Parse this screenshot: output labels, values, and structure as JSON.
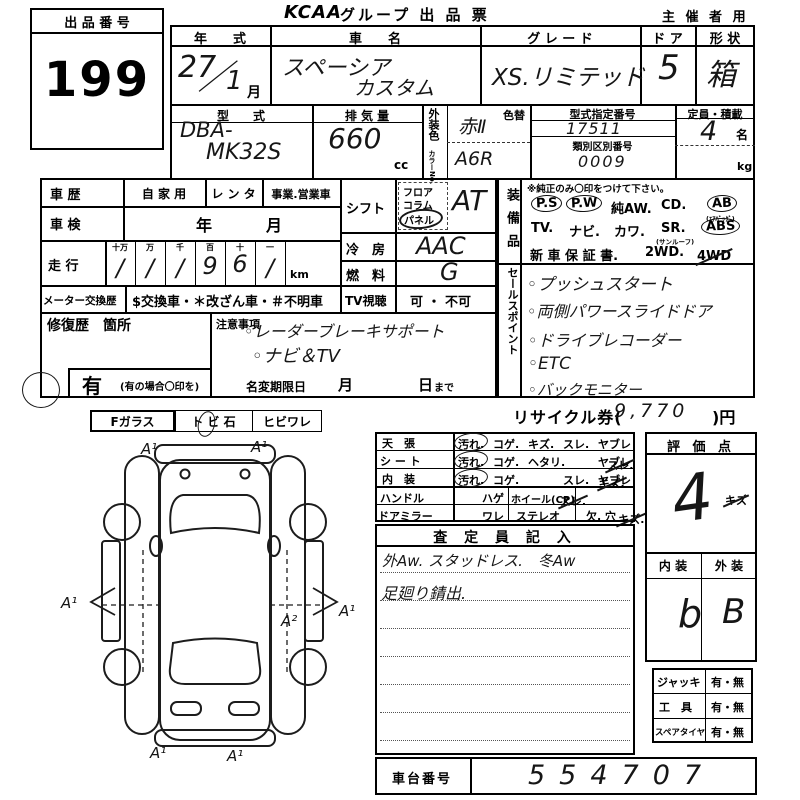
{
  "sheet": {
    "lot_label": "出 品 番 号",
    "lot_number": "199",
    "brand": "KCAA",
    "title": "グループ 出 品 票",
    "audience": "主 催 者 用"
  },
  "vehicle": {
    "year_label": "年　　式",
    "year_value": "27",
    "year_slash": "／",
    "year_month": "1",
    "month_unit": "月",
    "name_label": "車　　名",
    "name_value_1": "スペーシア",
    "name_value_2": "カスタム",
    "grade_label": "グ レ ー ド",
    "grade_value": "XS.リミテッド",
    "door_label": "ド ア",
    "door_value": "5",
    "shape_label": "形 状",
    "shape_value": "箱",
    "model_label": "型　　式",
    "model_value_1": "DBA-",
    "model_value_2": "MK32S",
    "disp_label": "排 気 量",
    "disp_value": "660",
    "disp_unit": "cc",
    "ext_color_label": "外装色",
    "color_no_label": "カラーNo.",
    "color_value": "赤Ⅱ",
    "color_no_value": "A6R",
    "color_change_label": "色替",
    "type_no_label": "型式指定番号",
    "type_no_value": "17511",
    "class_no_label": "類別区別番号",
    "class_no_value": "0009",
    "capacity_label": "定員・積載",
    "capacity_value": "4",
    "capacity_unit": "名",
    "weight_unit": "kg"
  },
  "history": {
    "label": "車 歴",
    "private": "自 家 用",
    "rental": "レ ン タ",
    "commercial": "事業.営業車",
    "inspection_label": "車 検",
    "inspection_year": "年",
    "inspection_month": "月",
    "mileage_label": "走 行",
    "mileage_cols": [
      "十万",
      "万",
      "千",
      "百",
      "十",
      "一"
    ],
    "mileage_digits": [
      "/",
      "/",
      "/",
      "9",
      "6",
      "/"
    ],
    "mileage_unit": "km",
    "meter_label": "メーター交換歴",
    "meter_codes": "$交換車・＊改ざん車・＃不明車",
    "tv_label": "TV視聴",
    "tv_options": "可 ・ 不可"
  },
  "controls": {
    "shift_label": "シフト",
    "shift_floor": "フロア",
    "shift_column": "コラム",
    "shift_panel": "パネル",
    "shift_value": "AT",
    "ac_label": "冷　房",
    "ac_value": "AAC",
    "fuel_label": "燃　料",
    "fuel_value": "G"
  },
  "repair": {
    "label": "修復歴　箇所",
    "has_label": "有",
    "has_note": "(有の場合〇印を)"
  },
  "notes": {
    "label": "注意事項",
    "bullet": "◦",
    "items": [
      "レーダーブレーキサポート",
      "ナビ＆TV"
    ],
    "deadline_label": "名変期限日",
    "deadline_month": "月",
    "deadline_day": "日",
    "deadline_until": "まで"
  },
  "equipment": {
    "label": "装備品",
    "note": "※純正のみ〇印をつけて下さい。",
    "row1": [
      "P.S",
      "P.W",
      "純AW.",
      "CD.",
      "AB"
    ],
    "row1_sub": "(ｴｱﾊﾞｯｸﾞ)",
    "row2": [
      "TV.",
      "ナビ.",
      "カワ.",
      "SR.",
      "ABS"
    ],
    "row2_sub": "(サンルーフ)",
    "row3": [
      "新 車 保 証 書.",
      "2WD.",
      "4WD"
    ],
    "circled": [
      "P.S",
      "P.W",
      "AB",
      "ABS"
    ]
  },
  "sales": {
    "label": "セールスポイント",
    "bullet": "◦",
    "items": [
      "プッシュスタート",
      "両側パワースライドドア",
      "ドライブレコーダー",
      "ETC",
      "バックモニター"
    ]
  },
  "recycle": {
    "label_prefix": "リサイクル券(",
    "value": "9,770",
    "label_suffix": ")円"
  },
  "condition": {
    "rows": [
      {
        "label": "天　張",
        "options": [
          "汚れ.",
          "コゲ.",
          "キズ.",
          "スレ.",
          "ヤブレ"
        ],
        "circled": "汚れ"
      },
      {
        "label": "シ ー ト",
        "options": [
          "汚れ.",
          "コゲ.",
          "ヘタリ.",
          "スレ.",
          "ヤブレ"
        ],
        "circled": "汚れ",
        "checked": "スレ"
      },
      {
        "label": "内　装",
        "options": [
          "汚れ.",
          "コゲ.",
          "キズ.",
          "スレ.",
          "ヤブレ"
        ],
        "circled": "汚れ",
        "checked": "キズ"
      }
    ],
    "handle_label": "ハンドル",
    "handle_opt1": "スレ.",
    "handle_opt2": "ハゲ",
    "wheel_label": "ホイール(CP)",
    "wheel_value": "キズ",
    "mirror_label": "ドアミラー",
    "mirror_opt1": "キズ.",
    "mirror_opt2": "ワレ",
    "stereo_label": "ステレオ",
    "stereo_value": "欠. 穴"
  },
  "assessor": {
    "header": "査 定 員 記 入",
    "line1": "外Aw. スタッドレス.　冬Aw",
    "line2": "足廻り錆出."
  },
  "evaluation": {
    "header": "評 価 点",
    "score": "4",
    "interior_label": "内 装",
    "exterior_label": "外 装",
    "interior_value": "b",
    "exterior_value": "B"
  },
  "accessories": {
    "rows": [
      {
        "label": "ジャッキ",
        "value": "有・無"
      },
      {
        "label": "工　具",
        "value": "有・無"
      },
      {
        "label": "スペアタイヤ",
        "value": "有・無"
      }
    ]
  },
  "chassis": {
    "label": "車台番号",
    "value": "554707"
  },
  "glass": {
    "f_glass": "Fガラス",
    "stone": "ト ビ 石",
    "crack": "ヒビワレ"
  },
  "diagram": {
    "marks": [
      "A¹",
      "A¹",
      "A¹",
      "A¹",
      "A²",
      "A¹",
      "A¹"
    ]
  }
}
